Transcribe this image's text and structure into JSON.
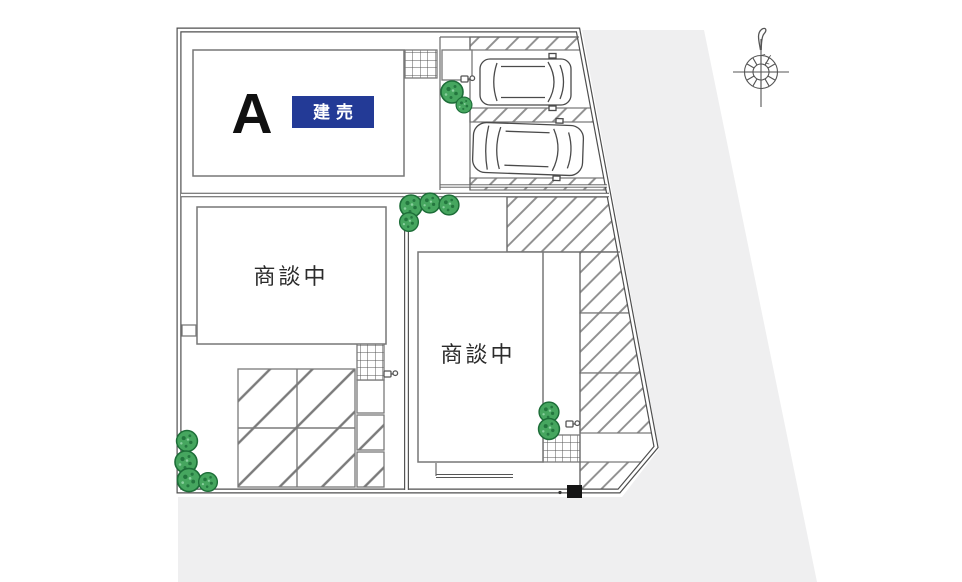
{
  "plan": {
    "lots": {
      "a": {
        "label": "A",
        "badge": "建売"
      },
      "b": {
        "status": "商談中"
      },
      "c": {
        "status": "商談中"
      }
    }
  },
  "icons": {
    "compass": "north-compass",
    "trees": "landscape-tree",
    "cars": "parked-car-topview"
  },
  "colors": {
    "badge_bg": "#233a96",
    "badge_text": "#ffffff",
    "road_gray": "#efeff0",
    "tree_green": "#46a65f",
    "tree_dark": "#1d6d38",
    "line_dark": "#4f4f4f"
  }
}
